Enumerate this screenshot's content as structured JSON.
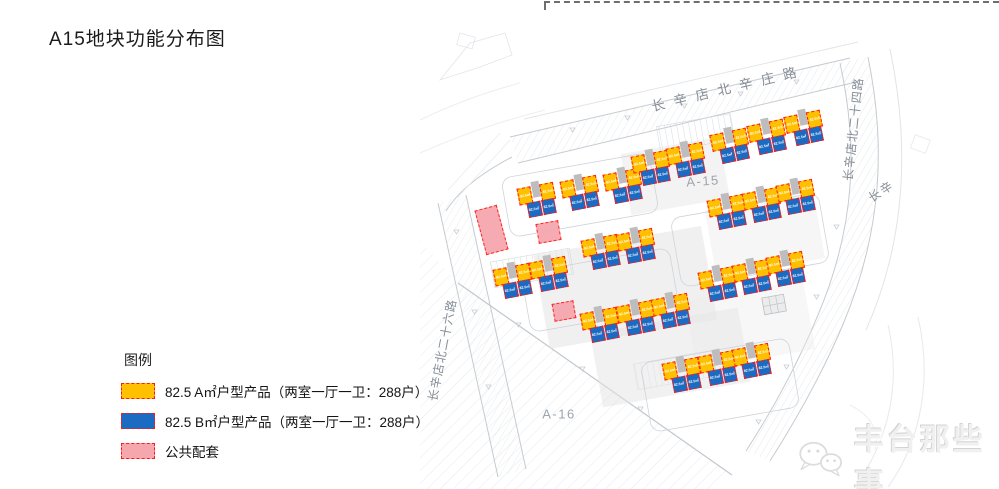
{
  "title": "A15地块功能分布图",
  "legend": {
    "heading": "图例",
    "items": [
      {
        "name": "type-a",
        "label": "82.5 A㎡户型产品（两室一厅一卫：288户）",
        "color": "#FFC000"
      },
      {
        "name": "type-b",
        "label": "82.5 B㎡户型产品（两室一厅一卫：288户）",
        "color": "#1B6BC2"
      },
      {
        "name": "amenity",
        "label": "公共配套",
        "color": "#F6A7AE"
      }
    ]
  },
  "colors": {
    "type_a": "#FFC000",
    "type_b": "#1B6BC2",
    "amenity": "#F6A7AE",
    "unit_border": "#FF1A1A",
    "stair_core": "#BDBDBD"
  },
  "map": {
    "unit_label": "82.5㎡",
    "area_labels": [
      {
        "text": "A-15",
        "x": 283,
        "y": 156,
        "rot": -4
      },
      {
        "text": "A-16",
        "x": 139,
        "y": 389,
        "rot": 0
      }
    ],
    "road_labels": [
      {
        "text": "长辛店北辛庄路",
        "x": 308,
        "y": 62,
        "rot": -13.5,
        "size": 13.5,
        "spacing": 9
      },
      {
        "text": "长辛店北二十四路",
        "x": 433,
        "y": 104,
        "rot": -84,
        "size": 12,
        "spacing": 1
      },
      {
        "text": "长辛",
        "x": 461,
        "y": 166,
        "rot": -33,
        "size": 12,
        "spacing": 2
      },
      {
        "text": "长辛店北二十六路",
        "x": 22,
        "y": 325,
        "rot": -79,
        "size": 12,
        "spacing": 1
      }
    ],
    "buildings": [
      {
        "x": 118,
        "y": 175,
        "rot": -11
      },
      {
        "x": 161,
        "y": 168,
        "rot": -11
      },
      {
        "x": 204,
        "y": 161,
        "rot": -11
      },
      {
        "x": 232,
        "y": 143,
        "rot": -11
      },
      {
        "x": 267,
        "y": 135,
        "rot": -11
      },
      {
        "x": 311,
        "y": 121,
        "rot": -12
      },
      {
        "x": 348,
        "y": 112,
        "rot": -12
      },
      {
        "x": 385,
        "y": 103,
        "rot": -12
      },
      {
        "x": 308,
        "y": 187,
        "rot": -11
      },
      {
        "x": 343,
        "y": 180,
        "rot": -11
      },
      {
        "x": 377,
        "y": 172,
        "rot": -11
      },
      {
        "x": 299,
        "y": 259,
        "rot": -11
      },
      {
        "x": 333,
        "y": 252,
        "rot": -11
      },
      {
        "x": 367,
        "y": 244,
        "rot": -11
      },
      {
        "x": 182,
        "y": 227,
        "rot": -11
      },
      {
        "x": 217,
        "y": 221,
        "rot": -11
      },
      {
        "x": 94,
        "y": 256,
        "rot": -11
      },
      {
        "x": 130,
        "y": 249,
        "rot": -11
      },
      {
        "x": 181,
        "y": 300,
        "rot": -11
      },
      {
        "x": 217,
        "y": 293,
        "rot": -11
      },
      {
        "x": 252,
        "y": 286,
        "rot": -11
      },
      {
        "x": 263,
        "y": 350,
        "rot": -11
      },
      {
        "x": 299,
        "y": 343,
        "rot": -11
      },
      {
        "x": 333,
        "y": 336,
        "rot": -11
      }
    ],
    "amenities": [
      {
        "x": 71,
        "y": 205,
        "w": 23,
        "h": 46,
        "rot": -15
      },
      {
        "x": 128,
        "y": 207,
        "w": 23,
        "h": 20,
        "rot": -10
      },
      {
        "x": 144,
        "y": 286,
        "w": 22,
        "h": 18,
        "rot": -10
      }
    ]
  },
  "watermark": {
    "text": "丰台那些事"
  }
}
